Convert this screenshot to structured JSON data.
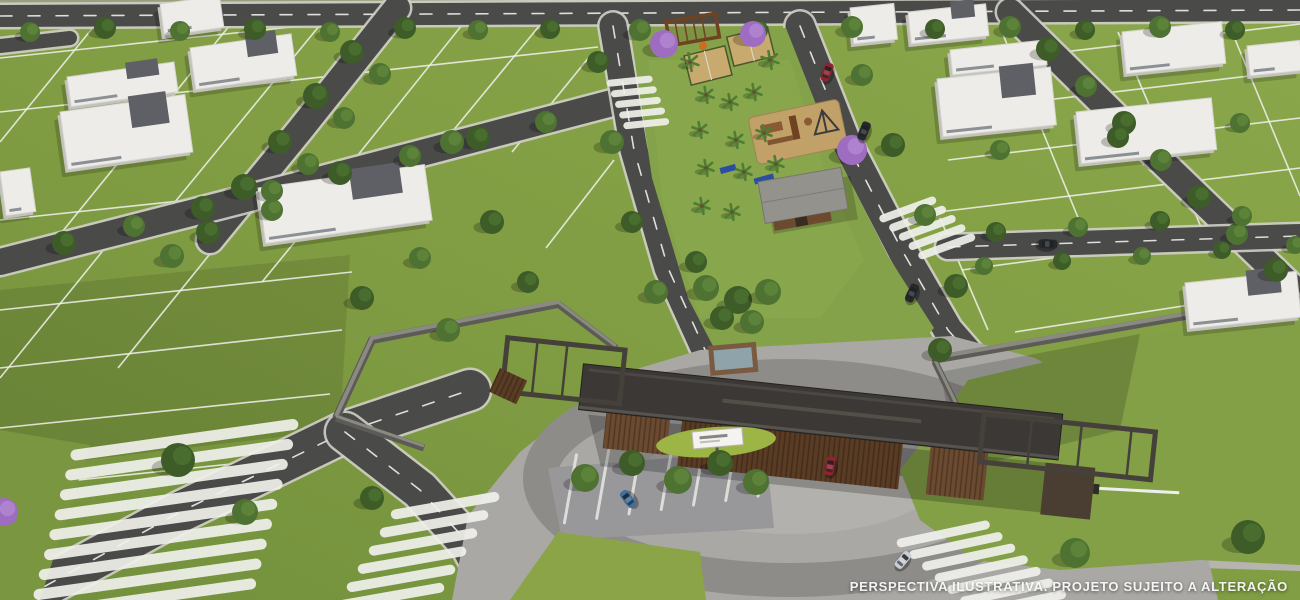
{
  "meta": {
    "kind": "aerial-architectural-render",
    "subject": "gated residential lot development with entrance portal, central linear park, tree-lined streets",
    "width": 1300,
    "height": 600
  },
  "overlay": {
    "disclaimer": "PERSPECTIVA ILUSTRATIVA. PROJETO SUJEITO A ALTERAÇÃO"
  },
  "palette": {
    "grass_base": "#819d43",
    "grass_light": "#8fae50",
    "grass_dark": "#6d8a38",
    "field_far": "#99a07f",
    "asphalt": "#4a4a49",
    "curb": "#cfcec6",
    "lane_dash": "#eeeeee",
    "lot_line": "#f2f2ee",
    "walkway": "#b5b4ae",
    "paver": "#a9a8a4",
    "paver_mid": "#98979a",
    "paver_dark": "#8d8c89",
    "court_dark": "#7d7c80",
    "wall_top": "#8a8982",
    "wall_side": "#5c5b58",
    "roof": "#3b3835",
    "frame": "#45403a",
    "corten": "#6b4a30",
    "corten_dark": "#5a3c24",
    "guard": "#4a3e33",
    "pool_deck": "#7a5a40",
    "pool_water": "#8fa3aa",
    "sand": "#c8aa6e",
    "sand_play": "#c2a168",
    "wood": "#8a5a32",
    "wood_dark": "#6e4322",
    "equip_blue": "#2b4fa0",
    "struct_dark": "#3c3c3c",
    "tree_green": "#4e7232",
    "tree_light": "#628a3c",
    "tree_dark": "#3d5c28",
    "tree_purple": "#9e6cc0",
    "tree_purple_light": "#b389d4",
    "palm": "#4e7d33",
    "trunk": "#6b4a30",
    "house_roof": "#edece8",
    "house_side": "#c2c1bb",
    "house_edge": "#d5d4ce",
    "house_tower": "#5f6066",
    "glass": "#3a4550",
    "sign_white": "#f4f3f0",
    "mound_green": "#9cb545",
    "car_red": "#8e2430",
    "car_dark": "#26282c",
    "car_blue": "#3f6f9e",
    "car_silver": "#c9ced4"
  },
  "scene": {
    "roads": [
      {
        "name": "perimeter-road-top",
        "pts": [
          [
            0,
            16
          ],
          [
            1300,
            10
          ]
        ],
        "w": 22,
        "dash": true
      },
      {
        "name": "road-stub-topleft",
        "pts": [
          [
            0,
            46
          ],
          [
            70,
            38
          ]
        ],
        "w": 14,
        "dash": false
      },
      {
        "name": "street-left-diagonal",
        "pts": [
          [
            397,
            8
          ],
          [
            300,
            130
          ],
          [
            210,
            240
          ]
        ],
        "w": 26,
        "dash": false
      },
      {
        "name": "street-left-cross",
        "pts": [
          [
            612,
            103
          ],
          [
            300,
            185
          ],
          [
            0,
            262
          ]
        ],
        "w": 26,
        "dash": false
      },
      {
        "name": "street-right-diagonal",
        "pts": [
          [
            1010,
            12
          ],
          [
            1155,
            155
          ],
          [
            1300,
            295
          ]
        ],
        "w": 26,
        "dash": false
      },
      {
        "name": "street-east-branch",
        "pts": [
          [
            948,
            247
          ],
          [
            1300,
            236
          ]
        ],
        "w": 24,
        "dash": true
      },
      {
        "name": "avenue-west-carriageway",
        "pts": [
          [
            613,
            26
          ],
          [
            634,
            150
          ],
          [
            668,
            268
          ],
          [
            706,
            352
          ],
          [
            732,
            382
          ]
        ],
        "w": 27,
        "dash": true
      },
      {
        "name": "avenue-east-carriageway",
        "pts": [
          [
            800,
            26
          ],
          [
            846,
            142
          ],
          [
            903,
            252
          ],
          [
            948,
            330
          ],
          [
            988,
            376
          ]
        ],
        "w": 29,
        "dash": true
      },
      {
        "name": "front-road-west",
        "pts": [
          [
            20,
            600
          ],
          [
            180,
            512
          ],
          [
            345,
            432
          ],
          [
            470,
            390
          ]
        ],
        "w": 40,
        "dash": true
      },
      {
        "name": "front-road-southwest",
        "pts": [
          [
            345,
            432
          ],
          [
            420,
            490
          ],
          [
            470,
            545
          ],
          [
            500,
            600
          ]
        ],
        "w": 38,
        "dash": true
      },
      {
        "name": "front-road-south",
        "pts": [
          [
            868,
            500
          ],
          [
            925,
            555
          ],
          [
            1000,
            600
          ]
        ],
        "w": 30,
        "dash": false
      },
      {
        "name": "walkway-lawn-edge",
        "pts": [
          [
            915,
            592
          ],
          [
            1060,
            572
          ],
          [
            1200,
            563
          ],
          [
            1300,
            566
          ]
        ],
        "w": 10,
        "dash": false,
        "light": true
      }
    ],
    "lot_lines": [
      [
        0,
        58,
        470,
        8
      ],
      [
        0,
        112,
        598,
        47
      ],
      [
        0,
        220,
        360,
        182
      ],
      [
        0,
        310,
        352,
        272
      ],
      [
        0,
        368,
        342,
        330
      ],
      [
        0,
        428,
        330,
        394
      ],
      [
        40,
        484,
        250,
        462
      ],
      [
        95,
        25,
        0,
        142
      ],
      [
        230,
        25,
        62,
        232
      ],
      [
        320,
        25,
        152,
        230
      ],
      [
        462,
        25,
        330,
        190
      ],
      [
        540,
        25,
        452,
        132
      ],
      [
        118,
        232,
        0,
        378
      ],
      [
        255,
        198,
        118,
        368
      ],
      [
        352,
        172,
        262,
        282
      ],
      [
        590,
        56,
        512,
        152
      ],
      [
        614,
        160,
        546,
        248
      ],
      [
        978,
        62,
        1300,
        24
      ],
      [
        962,
        110,
        1300,
        70
      ],
      [
        948,
        160,
        1300,
        118
      ],
      [
        938,
        212,
        1300,
        168
      ],
      [
        962,
        270,
        1300,
        225
      ],
      [
        1015,
        332,
        1300,
        288
      ],
      [
        1002,
        32,
        1088,
        242
      ],
      [
        1118,
        32,
        1204,
        234
      ],
      [
        1232,
        32,
        1300,
        196
      ],
      [
        940,
        218,
        988,
        330
      ]
    ],
    "walls": [
      {
        "name": "perimeter-wall-left-return",
        "pts": [
          [
            336,
            418
          ],
          [
            372,
            340
          ],
          [
            558,
            304
          ]
        ],
        "w": 8
      },
      {
        "name": "perimeter-wall-left-to-gate",
        "pts": [
          [
            558,
            304
          ],
          [
            616,
            348
          ]
        ],
        "w": 7
      },
      {
        "name": "perimeter-wall-left-front",
        "pts": [
          [
            336,
            418
          ],
          [
            424,
            448
          ]
        ],
        "w": 7
      },
      {
        "name": "perimeter-wall-right",
        "pts": [
          [
            932,
            360
          ],
          [
            1300,
            296
          ]
        ],
        "w": 8
      },
      {
        "name": "perimeter-wall-right-return",
        "pts": [
          [
            935,
            362
          ],
          [
            972,
            438
          ]
        ],
        "w": 7
      }
    ],
    "crosswalks": [
      {
        "name": "crosswalk-front-west",
        "cx": 195,
        "cy": 515,
        "rot": -8,
        "n": 9,
        "len": 230,
        "th": 11,
        "pitch": 19,
        "shear": -8
      },
      {
        "name": "crosswalk-front-southwest",
        "cx": 452,
        "cy": 545,
        "rot": -10,
        "n": 6,
        "len": 110,
        "th": 10,
        "pitch": 16,
        "shear": -14
      },
      {
        "name": "crosswalk-avenue-west",
        "cx": 632,
        "cy": 103,
        "rot": -6,
        "n": 5,
        "len": 46,
        "th": 7,
        "pitch": 11,
        "shear": 3
      },
      {
        "name": "crosswalk-avenue-east",
        "cx": 916,
        "cy": 232,
        "rot": -20,
        "n": 5,
        "len": 60,
        "th": 8,
        "pitch": 12,
        "shear": 6
      },
      {
        "name": "crosswalk-front-south",
        "cx": 952,
        "cy": 575,
        "rot": -12,
        "n": 7,
        "len": 95,
        "th": 9,
        "pitch": 14,
        "shear": 10
      }
    ],
    "parking_lines": {
      "name": "parking-bay-lines",
      "cx": 662,
      "cy": 505,
      "rot": -80,
      "n": 7,
      "len": 72,
      "th": 3,
      "pitch": 31,
      "shear": 10
    },
    "houses": [
      {
        "x": 160,
        "y": 4,
        "w": 60,
        "h": 32,
        "rot": -8,
        "tower": false
      },
      {
        "x": 67,
        "y": 77,
        "w": 108,
        "h": 30,
        "rot": -8,
        "tower": true
      },
      {
        "x": 190,
        "y": 48,
        "w": 102,
        "h": 42,
        "rot": -8,
        "tower": true
      },
      {
        "x": 60,
        "y": 112,
        "w": 126,
        "h": 58,
        "rot": -8,
        "tower": true
      },
      {
        "x": 258,
        "y": 188,
        "w": 168,
        "h": 56,
        "rot": -8,
        "tower": true
      },
      {
        "x": 0,
        "y": 172,
        "w": 30,
        "h": 44,
        "rot": -8,
        "tower": false
      },
      {
        "x": 850,
        "y": 8,
        "w": 44,
        "h": 36,
        "rot": -6,
        "tower": false
      },
      {
        "x": 908,
        "y": 12,
        "w": 78,
        "h": 32,
        "rot": -6,
        "tower": true
      },
      {
        "x": 950,
        "y": 50,
        "w": 95,
        "h": 25,
        "rot": -6,
        "tower": false
      },
      {
        "x": 937,
        "y": 79,
        "w": 114,
        "h": 58,
        "rot": -6,
        "tower": true
      },
      {
        "x": 1122,
        "y": 32,
        "w": 100,
        "h": 42,
        "rot": -6,
        "tower": false
      },
      {
        "x": 1247,
        "y": 46,
        "w": 53,
        "h": 30,
        "rot": -6,
        "tower": false
      },
      {
        "x": 1076,
        "y": 112,
        "w": 136,
        "h": 52,
        "rot": -6,
        "tower": false
      },
      {
        "x": 1185,
        "y": 283,
        "w": 112,
        "h": 46,
        "rot": -6,
        "tower": true
      }
    ],
    "top_houses": [
      [
        560,
        26
      ],
      [
        870,
        30
      ],
      [
        1020,
        40
      ],
      [
        1150,
        34
      ]
    ],
    "trees": [
      [
        30,
        32,
        10,
        "g"
      ],
      [
        105,
        28,
        11,
        "d"
      ],
      [
        180,
        31,
        10,
        "g"
      ],
      [
        255,
        29,
        11,
        "d"
      ],
      [
        330,
        32,
        10,
        "g"
      ],
      [
        405,
        28,
        11,
        "d"
      ],
      [
        478,
        30,
        10,
        "g"
      ],
      [
        550,
        29,
        10,
        "d"
      ],
      [
        640,
        30,
        11,
        "g"
      ],
      [
        758,
        30,
        10,
        "d"
      ],
      [
        852,
        27,
        11,
        "g"
      ],
      [
        935,
        29,
        10,
        "d"
      ],
      [
        1010,
        27,
        11,
        "g"
      ],
      [
        1085,
        30,
        10,
        "d"
      ],
      [
        1160,
        27,
        11,
        "g"
      ],
      [
        1235,
        30,
        10,
        "d"
      ],
      [
        352,
        52,
        12,
        "d"
      ],
      [
        380,
        74,
        11,
        "g"
      ],
      [
        316,
        96,
        13,
        "d"
      ],
      [
        344,
        118,
        11,
        "g"
      ],
      [
        280,
        142,
        12,
        "d"
      ],
      [
        308,
        164,
        11,
        "g"
      ],
      [
        244,
        187,
        13,
        "d"
      ],
      [
        272,
        210,
        11,
        "g"
      ],
      [
        208,
        232,
        12,
        "d"
      ],
      [
        172,
        256,
        12,
        "g"
      ],
      [
        546,
        122,
        11,
        "g"
      ],
      [
        478,
        138,
        12,
        "d"
      ],
      [
        410,
        156,
        11,
        "g"
      ],
      [
        340,
        173,
        12,
        "d"
      ],
      [
        272,
        191,
        11,
        "g"
      ],
      [
        203,
        208,
        12,
        "d"
      ],
      [
        134,
        226,
        11,
        "g"
      ],
      [
        64,
        243,
        12,
        "d"
      ],
      [
        1048,
        49,
        12,
        "d"
      ],
      [
        1086,
        86,
        11,
        "g"
      ],
      [
        1124,
        123,
        12,
        "d"
      ],
      [
        1161,
        160,
        11,
        "g"
      ],
      [
        1199,
        197,
        12,
        "d"
      ],
      [
        1237,
        234,
        11,
        "g"
      ],
      [
        1276,
        270,
        12,
        "d"
      ],
      [
        1000,
        150,
        10,
        "g"
      ],
      [
        1118,
        137,
        11,
        "d"
      ],
      [
        1240,
        123,
        10,
        "g"
      ],
      [
        996,
        232,
        10,
        "d"
      ],
      [
        1078,
        227,
        10,
        "g"
      ],
      [
        1160,
        221,
        10,
        "d"
      ],
      [
        1242,
        216,
        10,
        "g"
      ],
      [
        984,
        266,
        9,
        "g"
      ],
      [
        1062,
        261,
        9,
        "d"
      ],
      [
        1142,
        256,
        9,
        "g"
      ],
      [
        1222,
        250,
        9,
        "d"
      ],
      [
        1295,
        245,
        9,
        "g"
      ],
      [
        598,
        62,
        11,
        "d"
      ],
      [
        612,
        142,
        12,
        "g"
      ],
      [
        632,
        222,
        11,
        "d"
      ],
      [
        656,
        292,
        12,
        "g"
      ],
      [
        862,
        75,
        11,
        "g"
      ],
      [
        893,
        145,
        12,
        "d"
      ],
      [
        925,
        215,
        11,
        "g"
      ],
      [
        956,
        286,
        12,
        "d"
      ],
      [
        706,
        288,
        13,
        "g"
      ],
      [
        738,
        300,
        14,
        "d"
      ],
      [
        768,
        292,
        13,
        "g"
      ],
      [
        722,
        318,
        12,
        "d"
      ],
      [
        752,
        322,
        12,
        "g"
      ],
      [
        696,
        262,
        11,
        "d"
      ],
      [
        452,
        142,
        12,
        "g"
      ],
      [
        492,
        222,
        12,
        "d"
      ],
      [
        420,
        258,
        11,
        "g"
      ],
      [
        362,
        298,
        12,
        "d"
      ],
      [
        448,
        330,
        12,
        "g"
      ],
      [
        528,
        282,
        11,
        "d"
      ],
      [
        178,
        460,
        17,
        "d"
      ],
      [
        245,
        512,
        13,
        "g"
      ],
      [
        372,
        498,
        12,
        "d"
      ],
      [
        585,
        478,
        14,
        "g"
      ],
      [
        632,
        463,
        13,
        "d"
      ],
      [
        678,
        480,
        14,
        "g"
      ],
      [
        720,
        463,
        13,
        "d"
      ],
      [
        756,
        482,
        13,
        "g"
      ],
      [
        940,
        350,
        12,
        "d"
      ],
      [
        1075,
        553,
        15,
        "g"
      ],
      [
        1248,
        537,
        17,
        "d"
      ],
      [
        664,
        44,
        14,
        "p"
      ],
      [
        753,
        34,
        13,
        "p"
      ],
      [
        852,
        150,
        15,
        "p"
      ],
      [
        4,
        512,
        14,
        "p"
      ]
    ],
    "palms": [
      [
        690,
        62,
        9
      ],
      [
        770,
        60,
        9
      ],
      [
        706,
        95,
        8
      ],
      [
        730,
        102,
        8
      ],
      [
        754,
        92,
        8
      ],
      [
        700,
        130,
        8
      ],
      [
        736,
        140,
        8
      ],
      [
        764,
        133,
        8
      ],
      [
        706,
        168,
        8
      ],
      [
        744,
        172,
        8
      ],
      [
        776,
        164,
        8
      ],
      [
        702,
        206,
        8
      ],
      [
        732,
        212,
        8
      ]
    ],
    "cars": [
      {
        "name": "car-red-avenue",
        "x": 827,
        "y": 72,
        "rot": 20,
        "color": "#8e2430"
      },
      {
        "name": "car-dark-avenue-upper",
        "x": 864,
        "y": 131,
        "rot": 22,
        "color": "#26282c"
      },
      {
        "name": "car-dark-avenue-lower",
        "x": 912,
        "y": 293,
        "rot": 25,
        "color": "#26282c"
      },
      {
        "name": "car-dark-east-branch",
        "x": 1048,
        "y": 244,
        "rot": 92,
        "color": "#26282c"
      },
      {
        "name": "car-red-at-gate",
        "x": 830,
        "y": 466,
        "rot": 10,
        "color": "#8e2430"
      },
      {
        "name": "car-blue-parked",
        "x": 628,
        "y": 499,
        "rot": -38,
        "color": "#3f6f9e"
      },
      {
        "name": "car-silver-front-road",
        "x": 903,
        "y": 560,
        "rot": 40,
        "color": "#c9ced4"
      }
    ]
  }
}
